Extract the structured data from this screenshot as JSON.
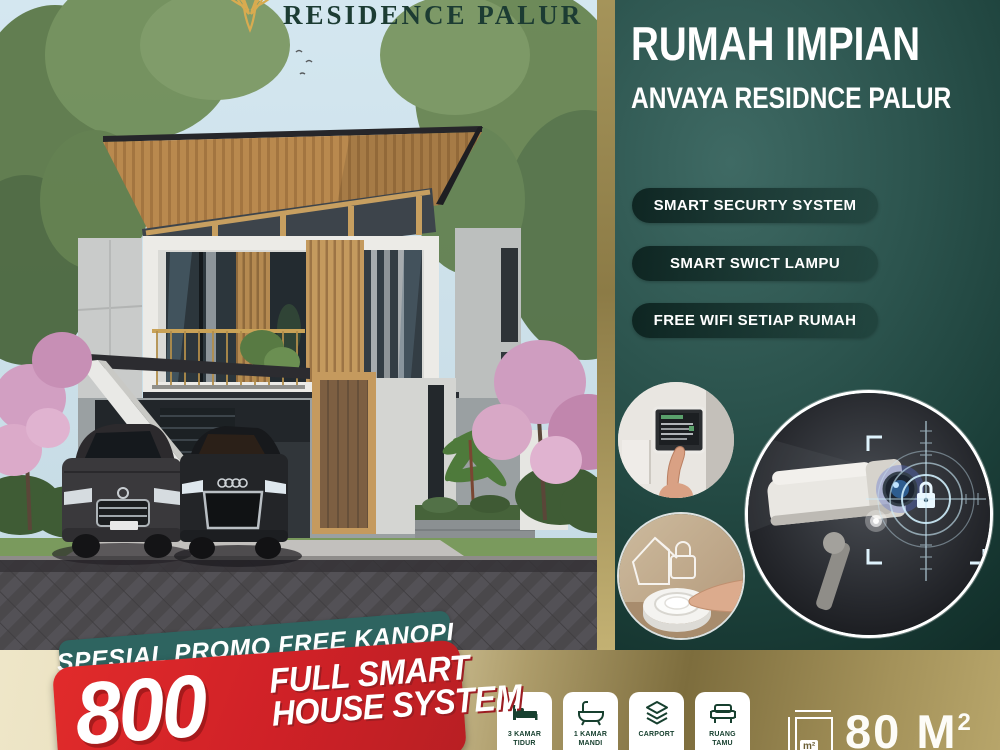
{
  "logo": {
    "text": "RESIDENCE PALUR"
  },
  "right_panel": {
    "title": "RUMAH IMPIAN",
    "subtitle": "ANVAYA RESIDNCE PALUR",
    "pills": [
      {
        "label": "SMART SECURTY SYSTEM"
      },
      {
        "label": "SMART SWICT LAMPU"
      },
      {
        "label": "FREE WIFI SETIAP RUMAH"
      }
    ],
    "images": [
      {
        "icon": "smart-panel-photo"
      },
      {
        "icon": "smart-button-photo"
      },
      {
        "icon": "cctv-camera-photo"
      }
    ]
  },
  "promo": {
    "ribbon": "SPESIAL PROMO FREE KANOPI",
    "price": "800",
    "tagline_line1": "FULL SMART",
    "tagline_line2": "HOUSE SYSTEM"
  },
  "specs": [
    {
      "icon": "bed-icon",
      "label_line1": "3 KAMAR",
      "label_line2": "TIDUR"
    },
    {
      "icon": "bathtub-icon",
      "label_line1": "1 KAMAR",
      "label_line2": "MANDI"
    },
    {
      "icon": "carport-icon",
      "label_line1": "CARPORT",
      "label_line2": ""
    },
    {
      "icon": "sofa-icon",
      "label_line1": "RUANG",
      "label_line2": "TAMU"
    }
  ],
  "area": {
    "icon_label": "m²",
    "value": "80 M",
    "superscript": "2"
  },
  "colors": {
    "panel_teal": "#2c544e",
    "pill_teal": "#16332e",
    "ribbon_teal": "#2e6460",
    "promo_red": "#cf2127",
    "gold": "#a08e52",
    "cream": "#ece4c6",
    "sky": "#cfe3ed"
  }
}
